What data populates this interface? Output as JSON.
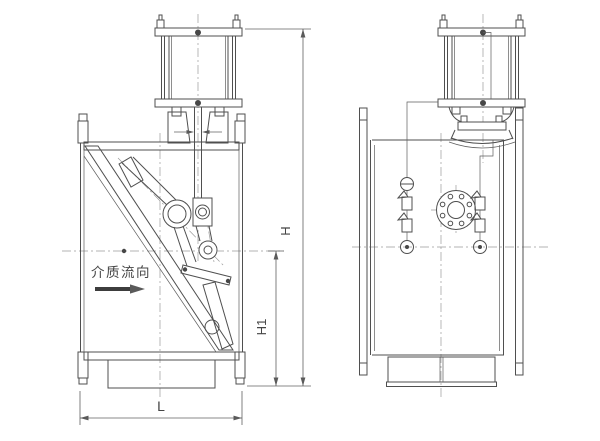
{
  "colors": {
    "background": "#ffffff",
    "line": "#4f4f4f",
    "centerline": "#9a9a9a",
    "hatch": "#6f6f6f",
    "text": "#454545",
    "flow_arrow": "#3d3d3d"
  },
  "annotations": {
    "flow_direction": "介质流向"
  },
  "dimension_labels": {
    "overall_height": "H",
    "center_to_bottom_height": "H1",
    "face_to_face_length": "L"
  }
}
